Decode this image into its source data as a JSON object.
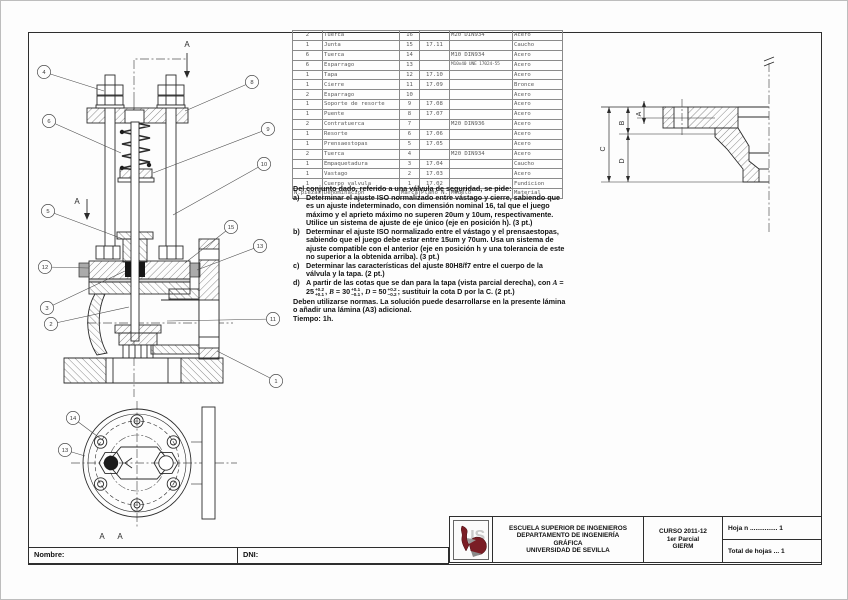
{
  "parts_table": {
    "headers": [
      "N.piezas",
      "Denominacion",
      "Marca",
      "Plano N.",
      "Modelo",
      "Material"
    ],
    "rows": [
      [
        "2",
        "Tuerca",
        "16",
        "",
        "M20 DIN934",
        "Acero"
      ],
      [
        "1",
        "Junta",
        "15",
        "17.11",
        "",
        "Caucho"
      ],
      [
        "6",
        "Tuerca",
        "14",
        "",
        "M10 DIN934",
        "Acero"
      ],
      [
        "6",
        "Esparrago",
        "13",
        "",
        "M10x40 UNE 17024-55",
        "Acero"
      ],
      [
        "1",
        "Tapa",
        "12",
        "17.10",
        "",
        "Acero"
      ],
      [
        "1",
        "Cierre",
        "11",
        "17.09",
        "",
        "Bronce"
      ],
      [
        "2",
        "Esparrago",
        "10",
        "",
        "",
        "Acero"
      ],
      [
        "1",
        "Soporte de resorte",
        "9",
        "17.08",
        "",
        "Acero"
      ],
      [
        "1",
        "Puente",
        "8",
        "17.07",
        "",
        "Acero"
      ],
      [
        "2",
        "Contratuerca",
        "7",
        "",
        "M20 DIN936",
        "Acero"
      ],
      [
        "1",
        "Resorte",
        "6",
        "17.06",
        "",
        "Acero"
      ],
      [
        "1",
        "Prensaestopas",
        "5",
        "17.05",
        "",
        "Acero"
      ],
      [
        "2",
        "Tuerca",
        "4",
        "",
        "M20 DIN934",
        "Acero"
      ],
      [
        "1",
        "Empaquetadura",
        "3",
        "17.04",
        "",
        "Caucho"
      ],
      [
        "1",
        "Vastago",
        "2",
        "17.03",
        "",
        "Acero"
      ],
      [
        "1",
        "Cuerpo valvula",
        "1",
        "17.02",
        "",
        "Fundicion"
      ]
    ]
  },
  "questions": {
    "intro": "Del conjunto dado, referido a una válvula de seguridad, se pide:",
    "item_a_label": "a)",
    "item_a": "Determinar el ajuste ISO normalizado entre vástago y cierre, sabiendo que es un ajuste indeterminado, con dimensión nominal 16, tal que el juego máximo y el aprieto máximo no superen 20um y 10um, respectivamente. Utilice un sistema de ajuste de eje único (eje en posición h). (3 pt.)",
    "item_b_label": "b)",
    "item_b": "Determinar el ajuste ISO normalizado entre el vástago y el prensaestopas, sabiendo que el juego debe estar entre 15um y 70um. Usa un sistema de ajuste compatible con el anterior (eje en posición h y una tolerancia de este no superior a la obtenida arriba). (3 pt.)",
    "item_c_label": "c)",
    "item_c": "Determinar las características del ajuste 80H8/f7 entre el cuerpo de la válvula y la tapa. (2 pt.)",
    "item_d": {
      "label": "d)",
      "pre": "A partir de las cotas que se dan para la tapa (vista parcial derecha), con ",
      "varA": "A",
      "eqA": " = 25",
      "supA": "+0.2",
      "subA": "+0.1",
      "sepAB": ", ",
      "varB": "B",
      "eqB": " = 30",
      "supB": "+0.1",
      "subB": "−0.1",
      "sepBD": ", ",
      "varD": "D",
      "eqD": " = 50",
      "supD": "+0.2",
      "subD": "−0.2",
      "post": "; sustituir la cota D por la C. (2 pt.)"
    },
    "closing": "Deben utilizarse normas. La solución puede desarrollarse en la presente lámina o añadir una lámina (A3) adicional.",
    "time": "Tiempo: 1h."
  },
  "title_block": {
    "school_lines": [
      "ESCUELA SUPERIOR DE INGENIEROS",
      "DEPARTAMENTO DE INGENIERÍA",
      "GRÁFICA",
      "UNIVERSIDAD DE SEVILLA"
    ],
    "curso_lines": [
      "CURSO 2011-12",
      "1er Parcial",
      "GIERM"
    ],
    "hoja_label": "Hoja n ............... 1",
    "total_label": "Total de hojas ... 1",
    "logo_color": "#7a1d25"
  },
  "footer": {
    "nombre_label": "Nombre:",
    "dni_label": "DNI:"
  },
  "drawing": {
    "line_color": "#2b2b2b",
    "balloons": [
      {
        "n": "4",
        "x": 43,
        "y": 71,
        "tx": 103,
        "ty": 90
      },
      {
        "n": "6",
        "x": 48,
        "y": 120,
        "tx": 120,
        "ty": 152
      },
      {
        "n": "5",
        "x": 47,
        "y": 210,
        "tx": 122,
        "ty": 238
      },
      {
        "n": "12",
        "x": 44,
        "y": 266,
        "tx": 88,
        "ty": 267
      },
      {
        "n": "3",
        "x": 46,
        "y": 307,
        "tx": 124,
        "ty": 270
      },
      {
        "n": "2",
        "x": 50,
        "y": 323,
        "tx": 128,
        "ty": 306
      },
      {
        "n": "8",
        "x": 251,
        "y": 81,
        "tx": 184,
        "ty": 110
      },
      {
        "n": "9",
        "x": 267,
        "y": 128,
        "tx": 152,
        "ty": 172
      },
      {
        "n": "10",
        "x": 263,
        "y": 163,
        "tx": 172,
        "ty": 214
      },
      {
        "n": "15",
        "x": 230,
        "y": 226,
        "tx": 184,
        "ty": 262
      },
      {
        "n": "13",
        "x": 259,
        "y": 245,
        "tx": 196,
        "ty": 269
      },
      {
        "n": "11",
        "x": 272,
        "y": 318,
        "tx": 166,
        "ty": 320
      },
      {
        "n": "1",
        "x": 275,
        "y": 380,
        "tx": 216,
        "ty": 350
      },
      {
        "n": "14",
        "x": 72,
        "y": 417,
        "tx": 100,
        "ty": 438
      },
      {
        "n": "13",
        "x": 64,
        "y": 449,
        "tx": 84,
        "ty": 455
      }
    ],
    "dim_labels": [
      {
        "t": "C",
        "x": 604,
        "y": 148
      },
      {
        "t": "B",
        "x": 623,
        "y": 122
      },
      {
        "t": "D",
        "x": 623,
        "y": 160
      },
      {
        "t": "A",
        "x": 640,
        "y": 113
      }
    ],
    "section_labels": [
      {
        "t": "A",
        "x": 186,
        "y": 46,
        "fs": 8
      },
      {
        "t": "A",
        "x": 76,
        "y": 203,
        "fs": 8
      },
      {
        "t": "A",
        "x": 101,
        "y": 538,
        "fs": 8
      },
      {
        "t": "A",
        "x": 119,
        "y": 538,
        "fs": 8
      }
    ]
  }
}
